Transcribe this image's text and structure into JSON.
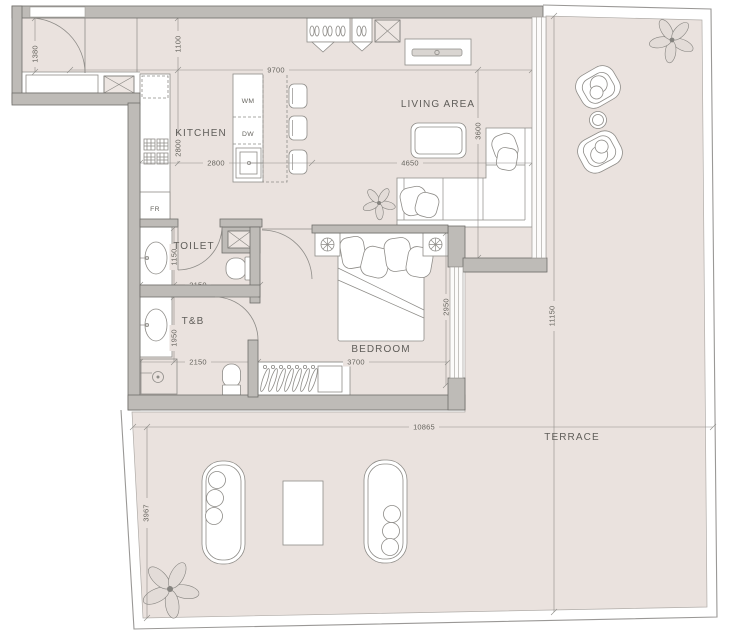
{
  "rooms": {
    "kitchen": "KITCHEN",
    "toilet": "TOILET",
    "t_and_b": "T&B",
    "bedroom": "BEDROOM",
    "living_area": "LIVING AREA",
    "terrace": "TERRACE"
  },
  "appliances": {
    "washing_machine": "WM",
    "dishwasher": "DW",
    "fridge": "FR"
  },
  "dims": {
    "entry_1380": "1380",
    "top_1100": "1100",
    "overall_9700": "9700",
    "kitchen_v_2800": "2800",
    "kitchen_h_2800": "2800",
    "living_4650": "4650",
    "living_3600": "3600",
    "toilet_1150": "1150",
    "toilet_2150": "2150",
    "tb_1950": "1950",
    "tb_2150": "2150",
    "bedroom_2950": "2950",
    "bedroom_3700": "3700",
    "terrace_10865": "10865",
    "terrace_11150": "11150",
    "terrace_3967": "3967"
  },
  "colors": {
    "floor": "#EAE2DE",
    "wall_fill": "#BEBBB7",
    "wall_stroke": "#6F6D69",
    "line": "#8E8C88",
    "text": "#5F5D59"
  }
}
